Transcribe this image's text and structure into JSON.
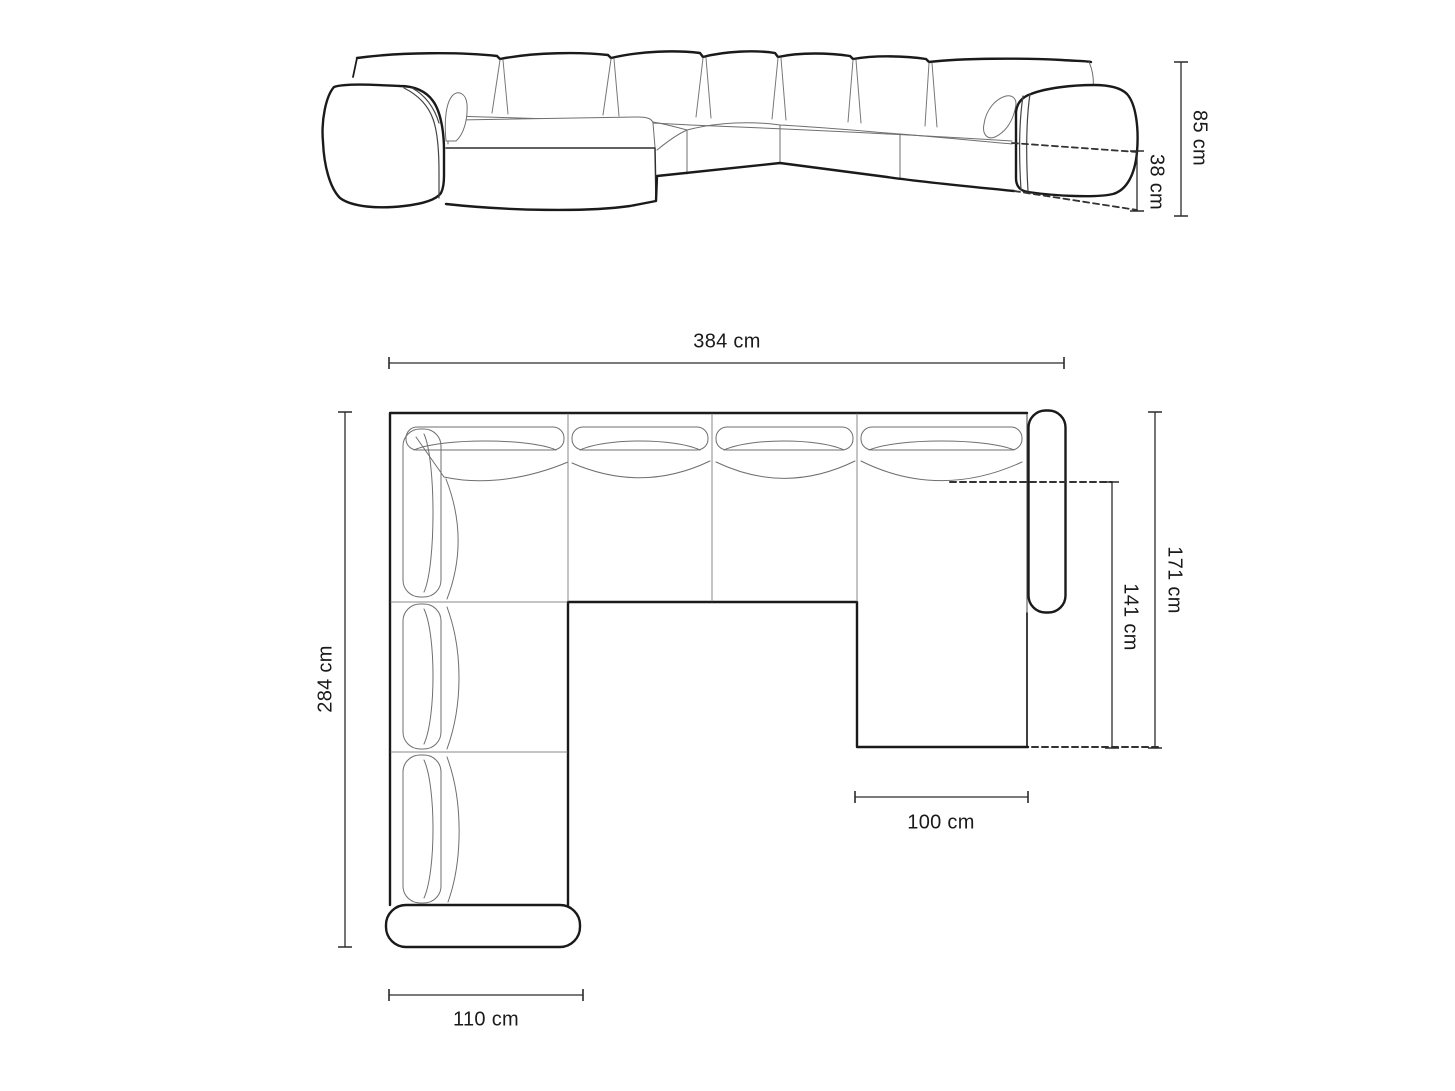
{
  "front_view": {
    "overall_height": "85 cm",
    "seat_height": "38 cm"
  },
  "top_view": {
    "overall_width": "384 cm",
    "left_side_depth": "284 cm",
    "right_side_depth": "171 cm",
    "right_inner_depth": "141 cm",
    "right_section_width": "100 cm",
    "left_section_width": "110 cm"
  },
  "colors": {
    "outline": "#1a1a1a",
    "detail_line": "#6f6f6f",
    "dimension_line": "#2b2b2b",
    "dashed_line": "#333333",
    "background": "#ffffff"
  }
}
